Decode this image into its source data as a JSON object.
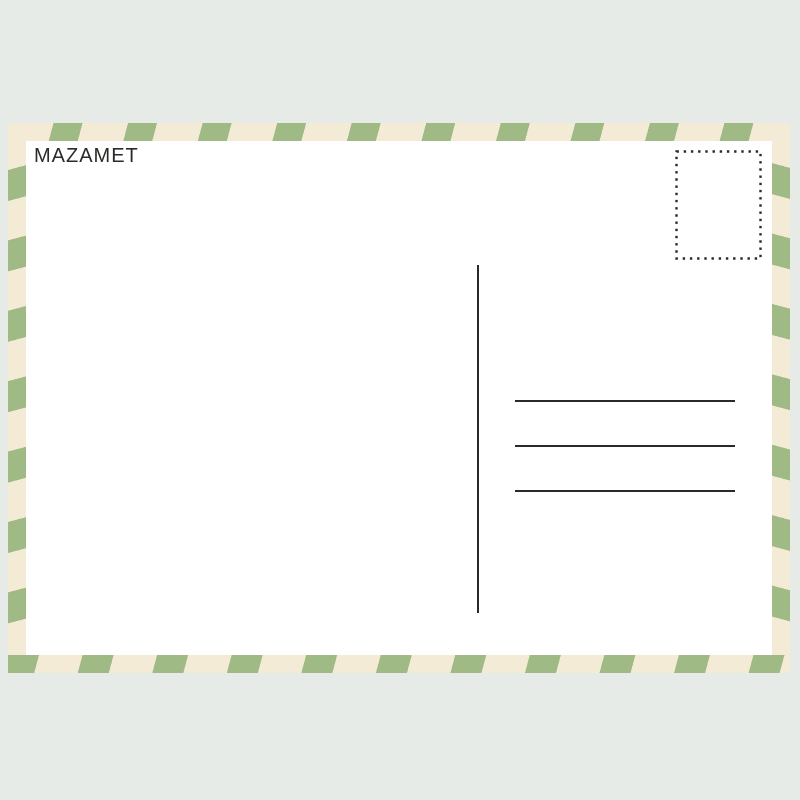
{
  "scene": {
    "background_color": "#e7ebe8"
  },
  "postcard": {
    "title": "MAZAMET",
    "colors": {
      "scene_bg": "#e7ebe8",
      "stripe_green": "#a0ba86",
      "stripe_cream": "#f4ebd6",
      "panel": "#ffffff",
      "ink": "#2b2a27"
    },
    "stamp_box": {
      "border_style": "dotted"
    },
    "address_lines": {
      "count": 3,
      "y_positions": [
        277,
        322,
        367
      ]
    }
  }
}
